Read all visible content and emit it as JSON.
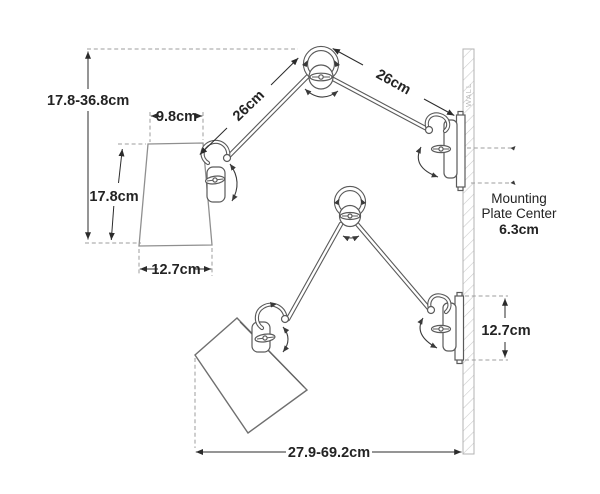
{
  "diagram": {
    "wall_label": "WALL",
    "upper_view": {
      "overall_height_range": "17.8-36.8cm",
      "shade_top_width": "9.8cm",
      "shade_height": "17.8cm",
      "shade_bottom_width": "12.7cm",
      "arm_to_shade_length": "26cm",
      "arm_to_wall_length": "26cm",
      "mounting_note_line1": "Mounting",
      "mounting_note_line2": "Plate Center",
      "mounting_note_value": "6.3cm"
    },
    "lower_view": {
      "backplate_height": "12.7cm",
      "extension_range": "27.9-69.2cm"
    },
    "colors": {
      "background": "#ffffff",
      "artwork_line": "#5a5a5a",
      "shade_outline": "#8f8f8f",
      "dimension_line": "#2b2b2b",
      "label_text": "#232323",
      "dashed_line": "#9e9e9e",
      "wall_hatch": "#c9c9c9",
      "wall_border": "#b3b3b3"
    }
  }
}
